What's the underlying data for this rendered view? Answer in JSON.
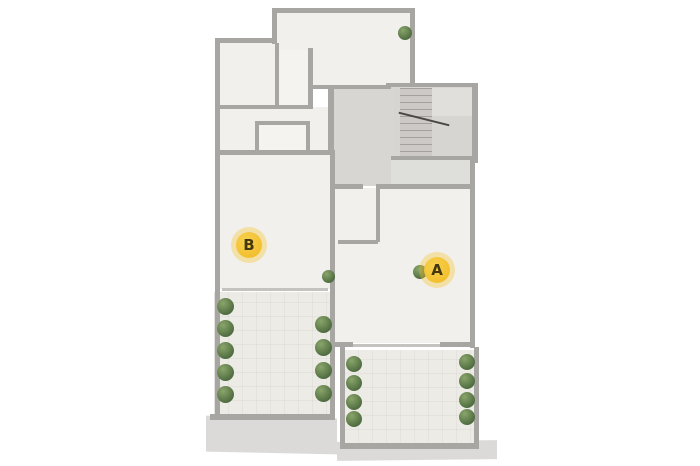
{
  "markers": {
    "a": {
      "label": "A"
    },
    "b": {
      "label": "B"
    }
  },
  "colors": {
    "bg": "#ffffff",
    "marker_bg": "#f2c02f",
    "marker_glow": "rgba(243,198,52,0.38)",
    "marker_text": "#44380f",
    "wall": "#a8a6a3",
    "floor": "#f2f0ec",
    "hall": "#d7d6d3",
    "entry": "#dededb",
    "terrace": "#edebe6",
    "wood": "#c9a478",
    "sofa": "#d49e6a",
    "sofa_dark": "#bf8a57",
    "plant_hi": "#8aa56b",
    "plant_mid": "#5d7a4a",
    "plant_dark": "#44603a",
    "dark_furniture": "#383531",
    "rug": "#f0e8e3",
    "rug_pink": "#eed6d8",
    "pouf_pink": "#e6bcc3",
    "apron": "#dbdad8"
  }
}
